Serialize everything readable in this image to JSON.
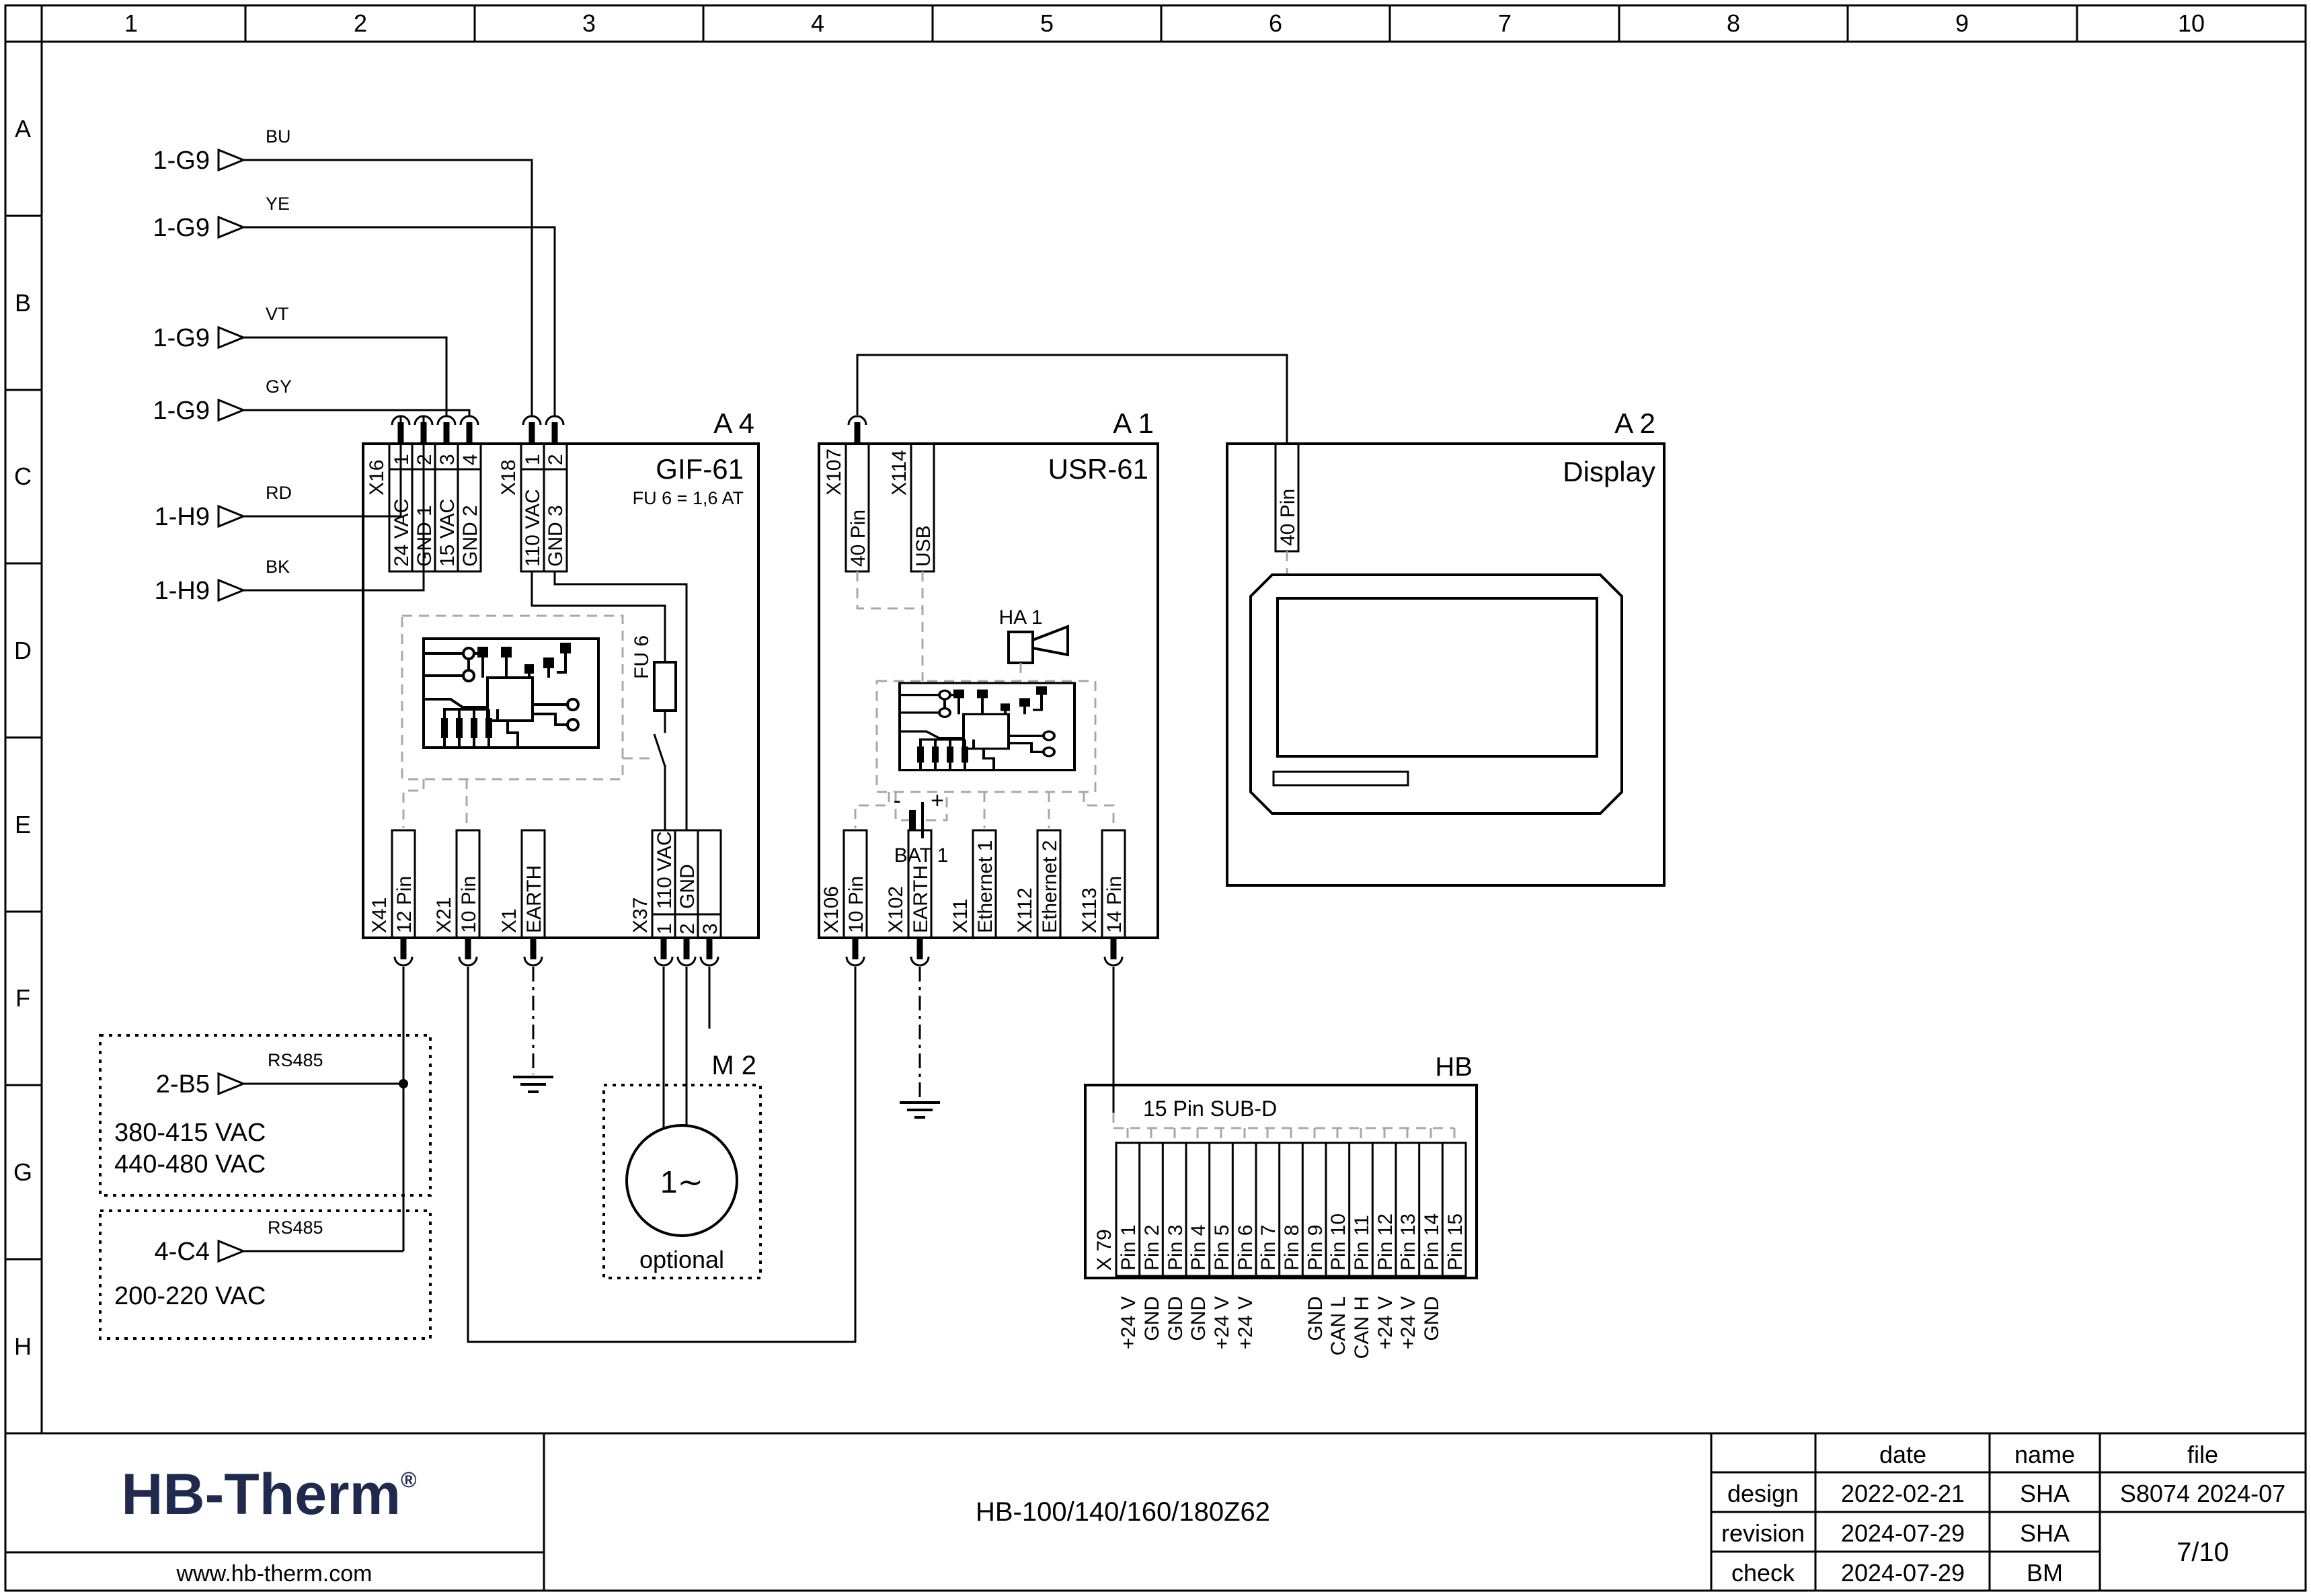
{
  "grid": {
    "columns": [
      "1",
      "2",
      "3",
      "4",
      "5",
      "6",
      "7",
      "8",
      "9",
      "10"
    ],
    "rows": [
      "A",
      "B",
      "C",
      "D",
      "E",
      "F",
      "G",
      "H"
    ]
  },
  "arrows": [
    {
      "target": "1-G9",
      "wire": "BU"
    },
    {
      "target": "1-G9",
      "wire": "YE"
    },
    {
      "target": "1-G9",
      "wire": "VT"
    },
    {
      "target": "1-G9",
      "wire": "GY"
    },
    {
      "target": "1-H9",
      "wire": "RD"
    },
    {
      "target": "1-H9",
      "wire": "BK"
    }
  ],
  "a4": {
    "ref": "A 4",
    "name": "GIF-61",
    "fuse_note": "FU 6 = 1,6 AT",
    "fuse_label": "FU 6",
    "x16": {
      "label": "X16",
      "pins": [
        "1",
        "2",
        "3",
        "4"
      ],
      "pin_labels": [
        "24 VAC",
        "GND 1",
        "15 VAC",
        "GND 2"
      ]
    },
    "x18": {
      "label": "X18",
      "pins": [
        "1",
        "2"
      ],
      "pin_labels": [
        "110 VAC",
        "GND 3"
      ]
    },
    "x41": {
      "label": "X41",
      "pin": "12 Pin"
    },
    "x21": {
      "label": "X21",
      "pin": "10 Pin"
    },
    "x1": {
      "label": "X1",
      "pin": "EARTH"
    },
    "x37": {
      "label": "X37",
      "pins": [
        "1",
        "2",
        "3"
      ],
      "pin_labels": [
        "110 VAC",
        "GND"
      ]
    }
  },
  "a1": {
    "ref": "A 1",
    "name": "USR-61",
    "x107": {
      "label": "X107",
      "pin": "40 Pin"
    },
    "x114": {
      "label": "X114",
      "pin": "USB"
    },
    "ha1": "HA 1",
    "bat": {
      "label": "BAT 1",
      "plus": "+",
      "minus": "-"
    },
    "x106": {
      "label": "X106",
      "pin": "10 Pin"
    },
    "x102": {
      "label": "X102",
      "pin": "EARTH"
    },
    "x11": {
      "label": "X11",
      "pin": "Ethernet 1"
    },
    "x112": {
      "label": "X112",
      "pin": "Ethernet 2"
    },
    "x113": {
      "label": "X113",
      "pin": "14 Pin"
    }
  },
  "a2": {
    "ref": "A 2",
    "name": "Display",
    "conn": "40 Pin"
  },
  "m2": {
    "ref": "M 2",
    "symbol": "1∼",
    "note": "optional"
  },
  "hb": {
    "ref": "HB",
    "title": "15 Pin SUB-D",
    "conn": "X 79",
    "pins": [
      "Pin 1",
      "Pin 2",
      "Pin 3",
      "Pin 4",
      "Pin 5",
      "Pin 6",
      "Pin 7",
      "Pin 8",
      "Pin 9",
      "Pin 10",
      "Pin 11",
      "Pin 12",
      "Pin 13",
      "Pin 14",
      "Pin 15"
    ],
    "functions": [
      "+24 V",
      "GND",
      "GND",
      "GND",
      "+24 V",
      "+24 V",
      "",
      "",
      "GND",
      "CAN L",
      "CAN H",
      "+24 V",
      "+24 V",
      "GND",
      ""
    ]
  },
  "b5": {
    "ref": "2-B5",
    "bus": "RS485",
    "line1": "380-415 VAC",
    "line2": "440-480 VAC"
  },
  "c4": {
    "ref": "4-C4",
    "bus": "RS485",
    "line1": "200-220 VAC"
  },
  "title_block": {
    "logo": "HB-Therm",
    "reg": "®",
    "url": "www.hb-therm.com",
    "model": "HB-100/140/160/180Z62",
    "col_date": "date",
    "col_name": "name",
    "col_file": "file",
    "row1": {
      "label": "design",
      "date": "2022-02-21",
      "name": "SHA"
    },
    "row2": {
      "label": "revision",
      "date": "2024-07-29",
      "name": "SHA"
    },
    "row3": {
      "label": "check",
      "date": "2024-07-29",
      "name": "BM"
    },
    "file": "S8074 2024-07",
    "page": "7/10"
  }
}
